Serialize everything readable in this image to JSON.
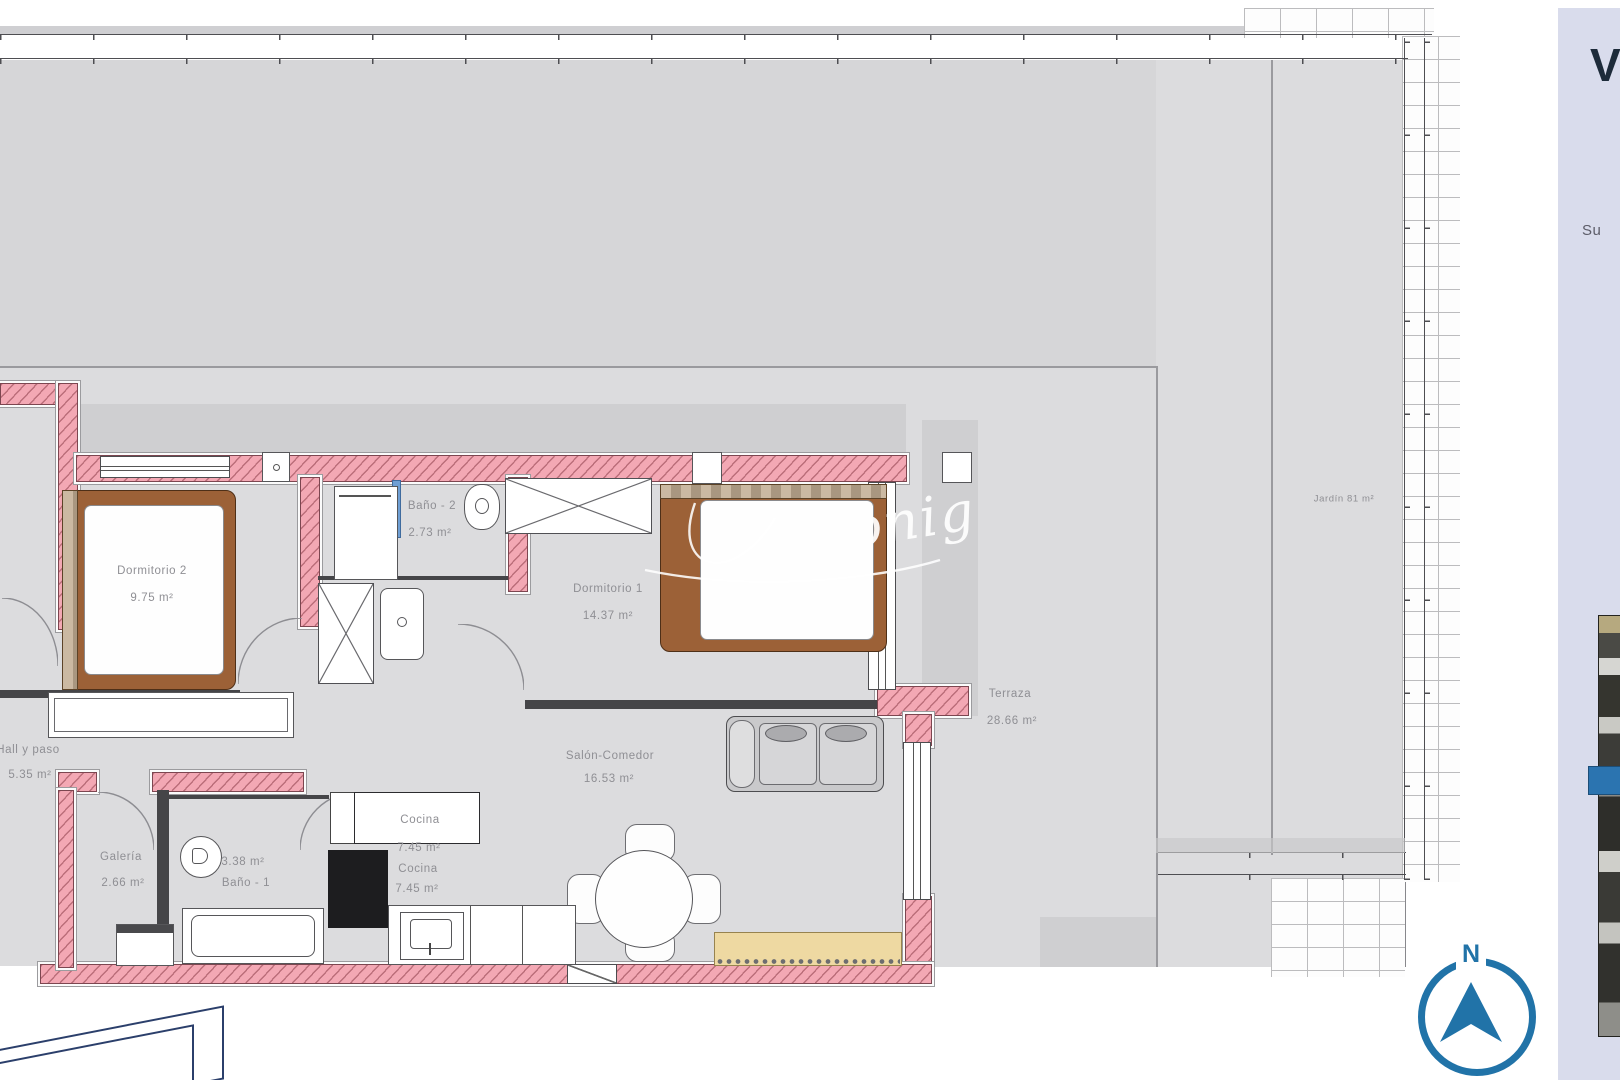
{
  "watermark": {
    "text": "Honig"
  },
  "rooms": {
    "dormitorio2": {
      "name": "Dormitorio 2",
      "area": "9.75 m²"
    },
    "bano2": {
      "name": "Baño - 2",
      "area": "2.73 m²"
    },
    "dormitorio1": {
      "name": "Dormitorio 1",
      "area": "14.37 m²"
    },
    "salon": {
      "name": "Salón-Comedor",
      "area": "16.53 m²"
    },
    "terraza": {
      "name": "Terraza",
      "area": "28.66 m²"
    },
    "cocina_counter": {
      "name": "Cocina",
      "area": "7.45 m²"
    },
    "cocina": {
      "name": "Cocina",
      "area": "7.45 m²"
    },
    "galeria": {
      "name": "Galería",
      "area": "2.66 m²"
    },
    "bano1": {
      "name": "Baño - 1",
      "area": "3.38 m²"
    },
    "hall": {
      "name": "Hall y paso",
      "area": "5.35 m²"
    },
    "jardin": {
      "name": "Jardín 81 m²"
    }
  },
  "compass": {
    "label": "N"
  },
  "side_panel": {
    "title_fragment": "V",
    "subtitle_fragment": "Su"
  },
  "colors": {
    "wall_pink": "#f3a8b4",
    "site_gray": "#dcdcde",
    "compass_blue": "#2173a8",
    "panel_lavender": "#d9dcec",
    "sideboard_yellow": "#eed9a2"
  }
}
